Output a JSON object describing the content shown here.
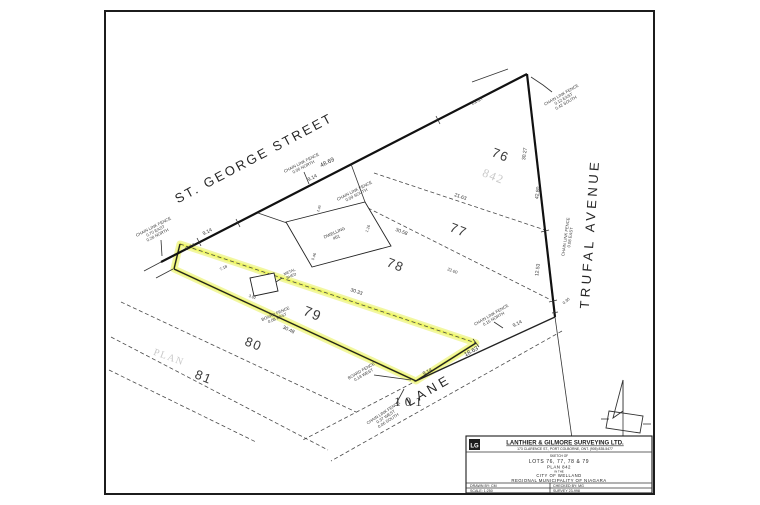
{
  "page": {
    "background": "#ffffff",
    "paper_border": "#1c1c1c",
    "highlight_color": "#e8f056"
  },
  "streets": {
    "st_george": "ST. GEORGE STREET",
    "trufal": "TRUFAL AVENUE",
    "lane": "LANE"
  },
  "lots": {
    "l76": "76",
    "l77": "77",
    "l78": "78",
    "l79": "79",
    "l80": "80",
    "l81": "81",
    "l101": "101"
  },
  "ghost": {
    "plan_word": "PLAN",
    "plan_number": "842"
  },
  "dims": {
    "street": {
      "a": "9.14",
      "b": "9.14",
      "c": "9.14",
      "d": "48.69",
      "e": "21.27"
    },
    "trufal": {
      "a": "30.27",
      "b": "42.80",
      "c": "12.53",
      "d": "0.30"
    },
    "lane": {
      "a": "9.14",
      "b": "18.63",
      "c": "9.14"
    },
    "lot_lines": {
      "l7677": "21.63",
      "l7778": "30.58",
      "l78b": "22.00",
      "l7879": "30.33",
      "l7980": "30.48"
    },
    "misc": {
      "a": "7.18",
      "b": "3.02",
      "c": "1.26",
      "d": "0.46",
      "e": "1.40"
    }
  },
  "fences": {
    "f1": [
      "CHAIN LINK FENCE",
      "0.70 EAST",
      "0.28 NORTH"
    ],
    "f2": [
      "CHAIN LINK FENCE",
      "0.06 NORTH"
    ],
    "f3": [
      "CHAIN LINK FENCE",
      "0.09 SOUTH"
    ],
    "f4": [
      "CHAIN LINK FENCE",
      "0.12 EAST",
      "0.42 SOUTH"
    ],
    "f5": [
      "CHAIN LINK FENCE",
      "0.08 EAST"
    ],
    "f6": [
      "CHAIN LINK FENCE",
      "0.15 NORTH"
    ],
    "f7": [
      "BOARD FENCE",
      "0.08 EAST"
    ],
    "f8": [
      "BOARD FENCE",
      "0.18 WEST"
    ],
    "f9": [
      "CHAIN LINK FENCE",
      "0.37 WEST",
      "0.06 SOUTH"
    ]
  },
  "structures": {
    "dwelling": [
      "DWELLING",
      "#61"
    ],
    "shed": [
      "METAL",
      "SHED"
    ]
  },
  "title_block": {
    "logo": "LG",
    "company": "LANTHIER & GILMORE SURVEYING LTD.",
    "address": "173 CLARENCE ST., PORT COLBORNE, ONT. (905) 835-5477",
    "sketch_of": "SKETCH OF",
    "lots_line": "LOTS 76, 77, 78 & 79",
    "plan_line": "PLAN 842",
    "in_the": "IN THE",
    "city": "CITY OF WELLAND",
    "region": "REGIONAL MUNICIPALITY OF NIAGARA",
    "drawn_by": "DRAWN BY:  CM",
    "checked_by": "CHECKED BY:  MG",
    "scale": "SCALE:  1:250",
    "survey": "SURVEY 23-998"
  }
}
